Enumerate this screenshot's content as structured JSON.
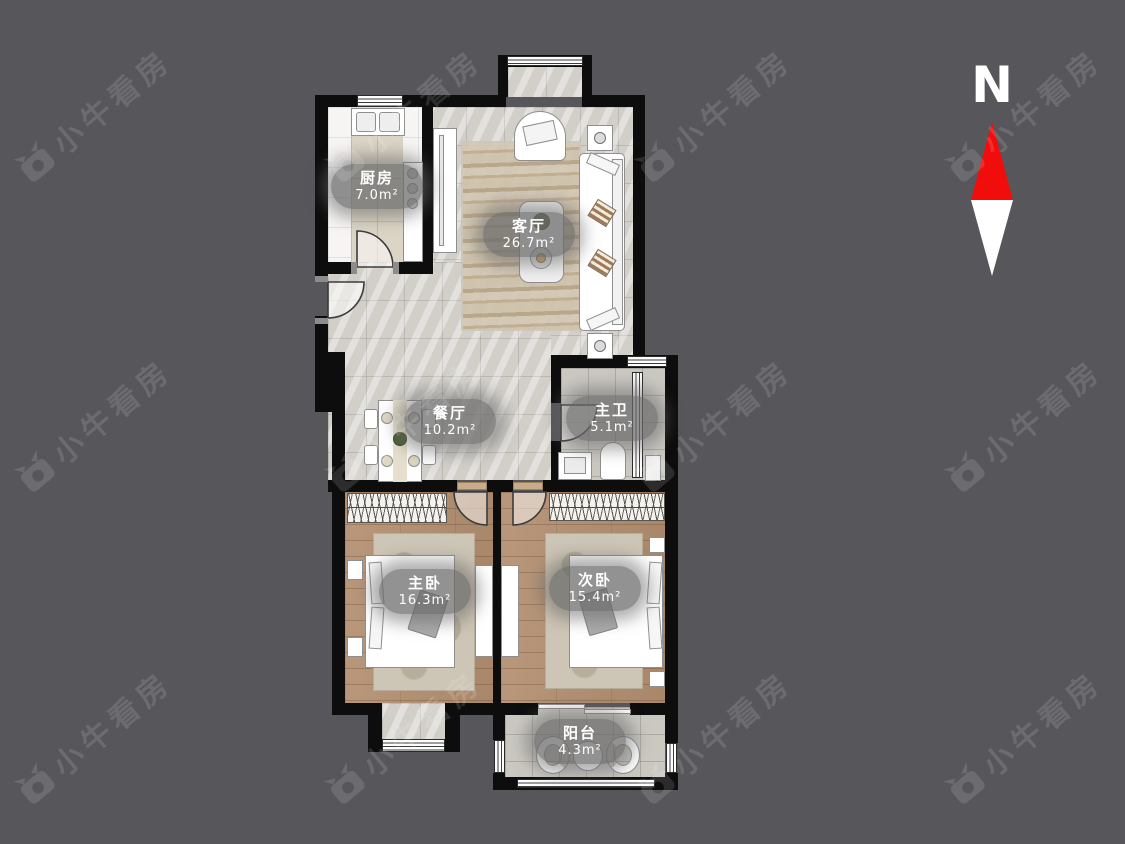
{
  "compass": {
    "label": "N",
    "icon": "north-arrow-icon"
  },
  "watermark": {
    "text": "小牛看房",
    "icon": "bull-logo-icon"
  },
  "floorplan": {
    "rooms": [
      {
        "id": "kitchen",
        "name": "厨房",
        "area": "7.0m²"
      },
      {
        "id": "living-room",
        "name": "客厅",
        "area": "26.7m²"
      },
      {
        "id": "dining-room",
        "name": "餐厅",
        "area": "10.2m²"
      },
      {
        "id": "master-bath",
        "name": "主卫",
        "area": "5.1m²"
      },
      {
        "id": "master-bedroom",
        "name": "主卧",
        "area": "16.3m²"
      },
      {
        "id": "second-bedroom",
        "name": "次卧",
        "area": "15.4m²"
      },
      {
        "id": "balcony",
        "name": "阳台",
        "area": "4.3m²"
      }
    ]
  },
  "colors": {
    "background": "#57565a",
    "wall": "#0d0d0d",
    "north_red": "#f20d0d",
    "watermark": "rgba(255,255,255,0.13)"
  }
}
